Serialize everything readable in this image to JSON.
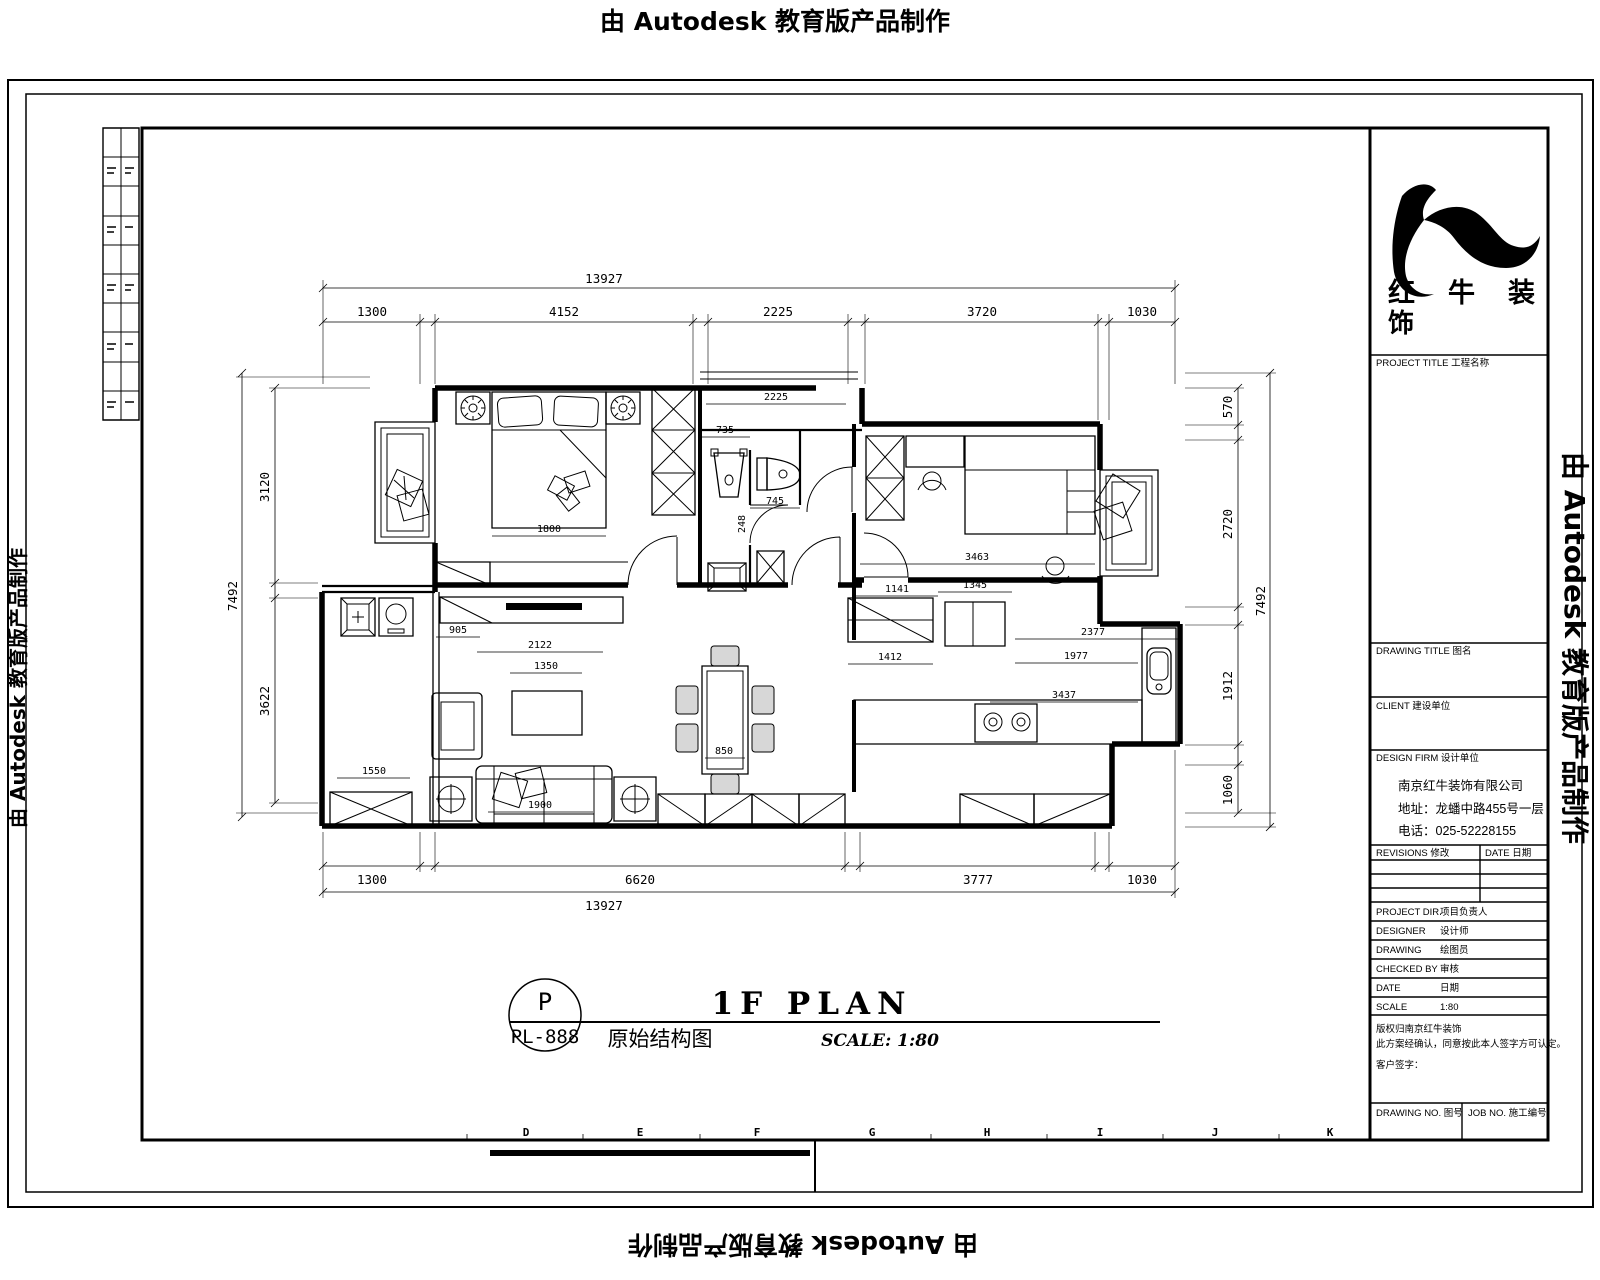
{
  "watermark": {
    "text": "由 Autodesk 教育版产品制作"
  },
  "title_block": {
    "logo": {
      "line1": "红牛装",
      "line2": "饰"
    },
    "project_title_label": "PROJECT TITLE  工程名称",
    "drawing_title_label": "DRAWING TITLE  图名",
    "client_label": "CLIENT  建设单位",
    "design_firm_label": "DESIGN FIRM  设计单位",
    "company_name": "南京红牛装饰有限公司",
    "company_address": "地址：龙蟠中路455号一层",
    "company_phone": "电话：025-52228155",
    "revisions_label": "REVISIONS  修改",
    "rev_date_label": "DATE 日期",
    "fields": [
      {
        "label": "PROJECT DIR.",
        "cn": "项目负责人"
      },
      {
        "label": "DESIGNER",
        "cn": "设计师"
      },
      {
        "label": "DRAWING",
        "cn": "绘图员"
      },
      {
        "label": "CHECKED BY",
        "cn": "审核"
      },
      {
        "label": "DATE",
        "cn": "日期"
      },
      {
        "label": "SCALE",
        "cn": "1:80"
      }
    ],
    "note_line1": "版权归南京红牛装饰",
    "note_line2": "此方案经确认，同意按此本人签字方可认定。",
    "client_sign": "客户签字：",
    "drawing_no_label": "DRAWING NO.  图号",
    "job_no_label": "JOB NO.  施工编号"
  },
  "dims": {
    "top": {
      "overall": "13927",
      "segments": [
        "1300",
        "4152",
        "2225",
        "3720",
        "1030"
      ]
    },
    "bottom": {
      "overall": "13927",
      "segments": [
        "1300",
        "6620",
        "3777",
        "1030"
      ]
    },
    "left": {
      "overall": "7492",
      "segments": [
        "3120",
        "3622"
      ]
    },
    "right": {
      "overall": "7492",
      "segments": [
        "570",
        "2720",
        "1912",
        "1060"
      ]
    }
  },
  "interior_dims": [
    "1800",
    "2225",
    "735",
    "745",
    "248",
    "3463",
    "1141",
    "1345",
    "905",
    "2122",
    "1350",
    "1550",
    "1900",
    "850",
    "1412",
    "2377",
    "1977",
    "3437"
  ],
  "grid_letters": [
    "D",
    "E",
    "F",
    "G",
    "H",
    "I",
    "J",
    "K"
  ],
  "title": {
    "tag_top": "P",
    "tag_bottom": "PL-888",
    "main": "1F PLAN",
    "sub": "原始结构图",
    "scale": "SCALE: 1:80"
  }
}
